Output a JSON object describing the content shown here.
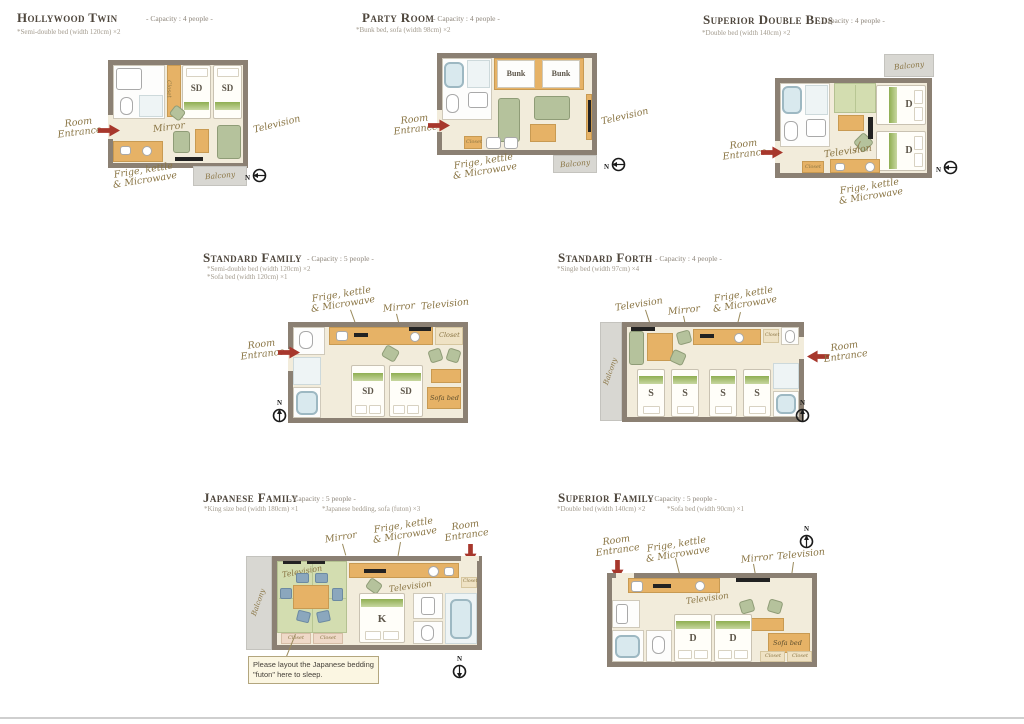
{
  "labels": {
    "room": "Room",
    "entrance": "Entrance",
    "television": "Television",
    "mirror": "Mirror",
    "frige1": "Frige, kettle",
    "frige2": "& Microwave",
    "balcony": "Balcony",
    "closet": "Closet",
    "sofa_bed": "Sofa bed",
    "bunk": "Bunk",
    "sd": "SD",
    "d": "D",
    "s": "S",
    "k": "K",
    "north": "N"
  },
  "rooms": {
    "hollywood_twin": {
      "title": "Hollywood Twin",
      "capacity": "- Capacity : 4 people -",
      "note": "*Semi-double bed (width 120cm) ×2"
    },
    "party_room": {
      "title": "Party Room",
      "capacity": "- Capacity : 4 people -",
      "note": "*Bunk bed, sofa (width 98cm) ×2"
    },
    "superior_double": {
      "title": "Superior Double Beds",
      "capacity": "- Capacity : 4 people -",
      "note": "*Double bed (width 140cm) ×2"
    },
    "standard_family": {
      "title": "Standard Family",
      "capacity": "- Capacity : 5 people -",
      "note1": "*Semi-double bed (width 120cm) ×2",
      "note2": "*Sofa bed (width 120cm) ×1"
    },
    "standard_forth": {
      "title": "Standard Forth",
      "capacity": "- Capacity : 4 people -",
      "note": "*Single bed (width 97cm) ×4"
    },
    "japanese_family": {
      "title": "Japanese Family",
      "capacity": "- Capacity : 5 people -",
      "note1": "*King size bed (width 180cm) ×1",
      "note2": "*Japanese bedding, sofa (futon) ×3",
      "futon1": "Please layout the Japanese bedding",
      "futon2": "\"futon\" here to sleep."
    },
    "superior_family": {
      "title": "Superior Family",
      "capacity": "- Capacity : 5 people -",
      "note1": "*Double bed (width 140cm) ×2",
      "note2": "*Sofa bed (width 90cm) ×1"
    }
  }
}
